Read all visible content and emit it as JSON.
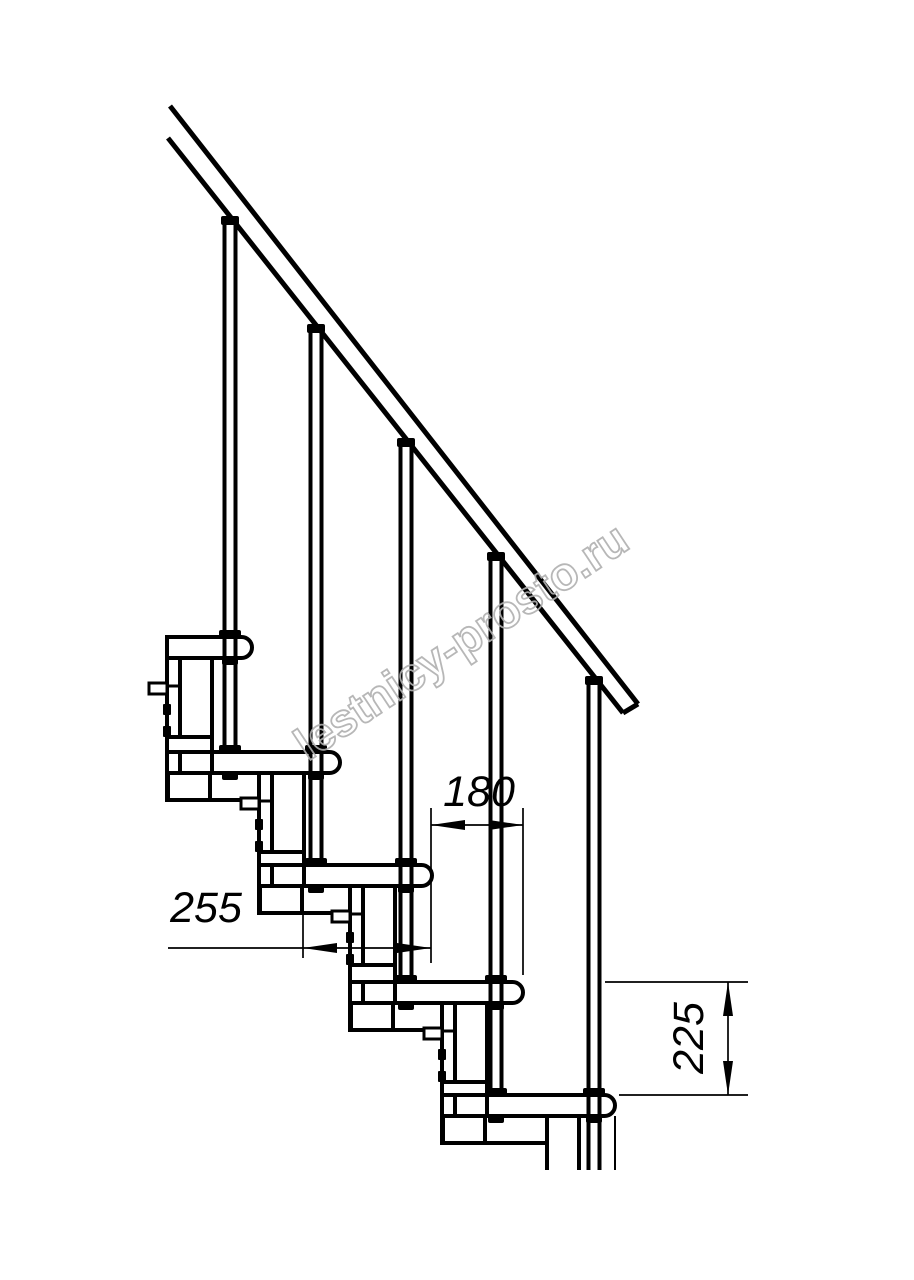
{
  "page": {
    "background": "#ffffff",
    "ink": "#000000",
    "watermark_color": "#b0b0b0"
  },
  "watermark": {
    "text": "lestnicy-prosto.ru",
    "cx": 461,
    "cy": 641,
    "angle_deg": -33.5,
    "font_size": 46
  },
  "dimensions": [
    {
      "id": "180",
      "label": "180",
      "text": {
        "x": 479,
        "y": 806,
        "rotate": 0
      },
      "ext_lines": [
        [
          431,
          808,
          431,
          963
        ],
        [
          523,
          808,
          523,
          975
        ]
      ],
      "dim_lines": [
        [
          431,
          825,
          523,
          825
        ]
      ],
      "arrows": [
        [
          431,
          825,
          465,
          820,
          465,
          830
        ],
        [
          523,
          825,
          489,
          820,
          489,
          830
        ]
      ]
    },
    {
      "id": "255",
      "label": "255",
      "text": {
        "x": 206,
        "y": 922,
        "rotate": 0
      },
      "ext_lines": [
        [
          303,
          915,
          303,
          958
        ]
      ],
      "dim_lines": [
        [
          168,
          948,
          431,
          948
        ]
      ],
      "arrows": [
        [
          303,
          948,
          337,
          943,
          337,
          953
        ],
        [
          431,
          948,
          397,
          943,
          397,
          953
        ]
      ]
    },
    {
      "id": "225",
      "label": "225",
      "text": {
        "x": 703,
        "y": 1038,
        "rotate": -90
      },
      "ext_lines": [
        [
          605,
          982,
          748,
          982
        ],
        [
          619,
          1095,
          748,
          1095
        ]
      ],
      "dim_lines": [
        [
          728,
          982,
          728,
          1095
        ]
      ],
      "arrows": [
        [
          728,
          982,
          723,
          1016,
          733,
          1016
        ],
        [
          728,
          1095,
          723,
          1061,
          733,
          1061
        ]
      ]
    }
  ],
  "staircase": {
    "tread_height": 21,
    "tread_end_radius": 10.5,
    "treads": [
      {
        "left": 167,
        "right": 252,
        "top": 637
      },
      {
        "left": 212,
        "right": 340,
        "top": 752
      },
      {
        "left": 304,
        "right": 432,
        "top": 865
      },
      {
        "left": 395,
        "right": 523,
        "top": 982
      },
      {
        "left": 487,
        "right": 615,
        "top": 1095
      }
    ],
    "balusters": [
      {
        "cx": 230,
        "top": 217,
        "bottom": 747,
        "feet": [
          637,
          752
        ],
        "nuts": [
          658,
          773
        ]
      },
      {
        "cx": 316,
        "top": 325,
        "bottom": 860,
        "feet": [
          752,
          865
        ],
        "nuts": [
          773,
          886
        ]
      },
      {
        "cx": 406,
        "top": 439,
        "bottom": 977,
        "feet": [
          865,
          982
        ],
        "nuts": [
          886,
          1003
        ]
      },
      {
        "cx": 496,
        "top": 553,
        "bottom": 1090,
        "feet": [
          982,
          1095
        ],
        "nuts": [
          1003,
          1116
        ]
      },
      {
        "cx": 594,
        "top": 677,
        "bottom": 1170,
        "feet": [
          1095
        ],
        "nuts": [
          1116
        ]
      }
    ],
    "modules": [
      {
        "flank": [
          167,
          658,
          13,
          142
        ],
        "column": [
          180,
          658,
          32,
          79
        ],
        "flange": [
          167,
          737,
          45,
          15
        ],
        "sockets": [
          [
            168,
            773,
            42,
            27
          ],
          [
            210,
            773,
            62,
            27
          ]
        ],
        "seam": [
          167,
          686,
          180,
          686
        ],
        "tab": [
          149,
          683,
          18,
          11
        ],
        "bolts": [
          [
            163,
            704,
            8,
            11
          ],
          [
            163,
            726,
            8,
            11
          ]
        ]
      },
      {
        "flank": [
          259,
          773,
          13,
          140
        ],
        "column": [
          272,
          773,
          32,
          79
        ],
        "flange": [
          259,
          852,
          45,
          13
        ],
        "sockets": [
          [
            260,
            886,
            42,
            27
          ],
          [
            302,
            886,
            61,
            27
          ]
        ],
        "seam": [
          259,
          801,
          272,
          801
        ],
        "tab": [
          241,
          798,
          18,
          11
        ],
        "bolts": [
          [
            255,
            819,
            8,
            11
          ],
          [
            255,
            841,
            8,
            11
          ]
        ]
      },
      {
        "flank": [
          350,
          886,
          13,
          144
        ],
        "column": [
          363,
          886,
          32,
          79
        ],
        "flange": [
          350,
          965,
          45,
          17
        ],
        "sockets": [
          [
            351,
            1003,
            42,
            27
          ],
          [
            393,
            1003,
            62,
            27
          ]
        ],
        "seam": [
          350,
          914,
          363,
          914
        ],
        "tab": [
          332,
          911,
          18,
          11
        ],
        "bolts": [
          [
            346,
            932,
            8,
            11
          ],
          [
            346,
            954,
            8,
            11
          ]
        ]
      },
      {
        "flank": [
          442,
          1003,
          13,
          140
        ],
        "column": [
          455,
          1003,
          32,
          79
        ],
        "flange": [
          442,
          1082,
          45,
          13
        ],
        "sockets": [
          [
            443,
            1116,
            42,
            27
          ],
          [
            485,
            1116,
            62,
            27
          ]
        ],
        "seam": [
          442,
          1031,
          455,
          1031
        ],
        "tab": [
          424,
          1028,
          18,
          11
        ],
        "bolts": [
          [
            438,
            1049,
            8,
            11
          ],
          [
            438,
            1071,
            8,
            11
          ]
        ]
      }
    ],
    "lower_module_lines": [
      [
        547,
        1143,
        547,
        1170
      ],
      [
        579,
        1116,
        579,
        1170
      ]
    ],
    "lower_module_thin_lines": [
      [
        615,
        1116,
        615,
        1170
      ]
    ],
    "rail": {
      "lines": [
        [
          170,
          106,
          638,
          704
        ],
        [
          168,
          138,
          623,
          713
        ],
        [
          638,
          704,
          623,
          713
        ]
      ]
    }
  }
}
